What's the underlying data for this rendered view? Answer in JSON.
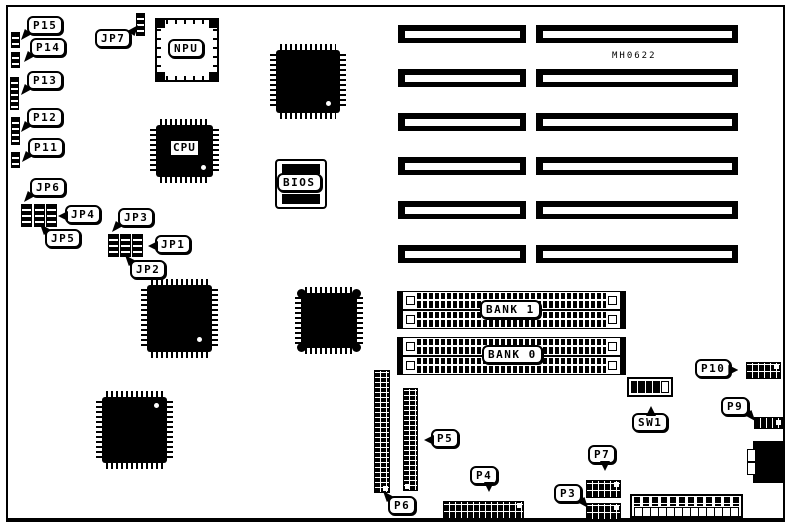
{
  "board": {
    "part_number": "MH0622"
  },
  "colors": {
    "ink": "#000000",
    "paper": "#ffffff"
  },
  "labels": {
    "p15": "P15",
    "p14": "P14",
    "p13": "P13",
    "p12": "P12",
    "p11": "P11",
    "jp7": "JP7",
    "jp6": "JP6",
    "jp5": "JP5",
    "jp4": "JP4",
    "jp3": "JP3",
    "jp2": "JP2",
    "jp1": "JP1",
    "p3": "P3",
    "p4": "P4",
    "p5": "P5",
    "p6": "P6",
    "p7": "P7",
    "p9": "P9",
    "p10": "P10"
  },
  "chips": {
    "npu": "NPU",
    "cpu": "CPU",
    "bios": "BIOS"
  },
  "memory": {
    "bank1": "BANK 1",
    "bank0": "BANK 0"
  },
  "switch": {
    "sw1": "SW1"
  }
}
